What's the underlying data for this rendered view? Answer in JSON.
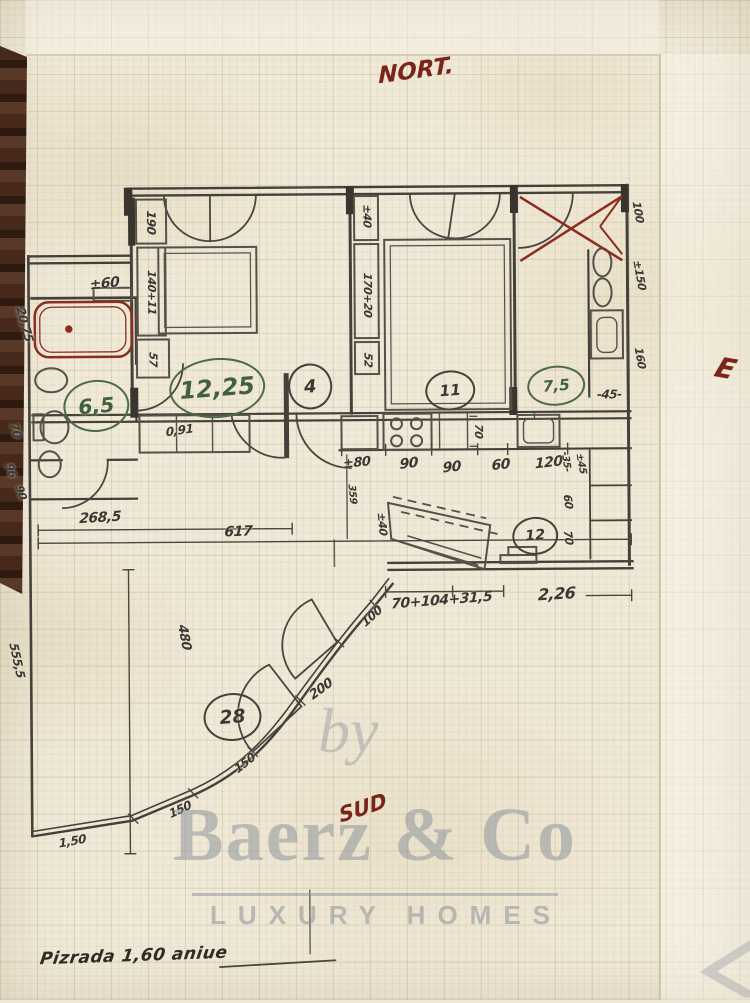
{
  "compass": {
    "north": "NORT.",
    "south": "SUD",
    "east": "E"
  },
  "note_bottom": "Pizrada 1,60 aniue",
  "watermark": {
    "by": "by",
    "brand": "Baerz & Co",
    "tagline": "LUXURY HOMES"
  },
  "colors": {
    "ink": "#3b3732",
    "red_ink": "#8c2d20",
    "maroon": "#7b241a",
    "green_ink": "#41603e",
    "paper": "#f0e9d7",
    "wood": "#46291b",
    "watermark_gray": "#8b929b"
  },
  "room_areas": [
    {
      "value": "6,5",
      "x": 97,
      "y": 404,
      "rx": 31,
      "ry": 24,
      "c": "green"
    },
    {
      "value": "12,25",
      "x": 218,
      "y": 387,
      "rx": 46,
      "ry": 28,
      "c": "green"
    },
    {
      "value": "4",
      "x": 311,
      "y": 386,
      "rx": 20,
      "ry": 21,
      "c": "ink"
    },
    {
      "value": "11",
      "x": 451,
      "y": 391,
      "rx": 23,
      "ry": 18,
      "c": "ink"
    },
    {
      "value": "7,5",
      "x": 557,
      "y": 387,
      "rx": 27,
      "ry": 18,
      "c": "green"
    },
    {
      "value": "12",
      "x": 535,
      "y": 537,
      "rx": 21,
      "ry": 17,
      "c": "ink"
    },
    {
      "value": "28",
      "x": 231,
      "y": 716,
      "rx": 27,
      "ry": 22,
      "c": "ink"
    }
  ],
  "dimensions": [
    {
      "t": "±60",
      "x": 106,
      "y": 282,
      "r": -6,
      "s": 14
    },
    {
      "t": "190",
      "x": 153,
      "y": 221,
      "r": 90,
      "s": 12
    },
    {
      "t": "140+11",
      "x": 153,
      "y": 291,
      "r": 90,
      "s": 11
    },
    {
      "t": "57",
      "x": 154,
      "y": 358,
      "r": 90,
      "s": 11
    },
    {
      "t": "20,75",
      "x": 26,
      "y": 322,
      "r": 75,
      "s": 12
    },
    {
      "t": "70",
      "x": 16,
      "y": 428,
      "r": 72,
      "s": 12
    },
    {
      "t": "96",
      "x": 11,
      "y": 468,
      "r": 72,
      "s": 11
    },
    {
      "t": "90",
      "x": 21,
      "y": 490,
      "r": 72,
      "s": 11
    },
    {
      "t": "555,5",
      "x": 16,
      "y": 658,
      "r": 78,
      "s": 12
    },
    {
      "t": "0,91",
      "x": 180,
      "y": 429,
      "r": -8,
      "s": 12
    },
    {
      "t": "±80",
      "x": 357,
      "y": 463,
      "r": -6,
      "s": 13
    },
    {
      "t": "90",
      "x": 409,
      "y": 464,
      "r": -6,
      "s": 14
    },
    {
      "t": "90",
      "x": 452,
      "y": 468,
      "r": -6,
      "s": 14
    },
    {
      "t": "60",
      "x": 501,
      "y": 466,
      "r": -6,
      "s": 14
    },
    {
      "t": "120",
      "x": 549,
      "y": 464,
      "r": -6,
      "s": 14
    },
    {
      "t": "±45",
      "x": 581,
      "y": 465,
      "r": 80,
      "s": 10
    },
    {
      "t": "70",
      "x": 479,
      "y": 432,
      "r": 90,
      "s": 11
    },
    {
      "t": "-45-",
      "x": 610,
      "y": 396,
      "r": 0,
      "s": 12
    },
    {
      "t": "±40",
      "x": 369,
      "y": 216,
      "r": 90,
      "s": 11
    },
    {
      "t": "170+20",
      "x": 369,
      "y": 295,
      "r": 90,
      "s": 11
    },
    {
      "t": "52",
      "x": 369,
      "y": 360,
      "r": 90,
      "s": 11
    },
    {
      "t": "100",
      "x": 640,
      "y": 214,
      "r": 80,
      "s": 11
    },
    {
      "t": "±150",
      "x": 641,
      "y": 277,
      "r": 80,
      "s": 11
    },
    {
      "t": "160",
      "x": 641,
      "y": 360,
      "r": 80,
      "s": 11
    },
    {
      "t": "-35-",
      "x": 566,
      "y": 463,
      "r": 82,
      "s": 10
    },
    {
      "t": "60",
      "x": 568,
      "y": 503,
      "r": 82,
      "s": 11
    },
    {
      "t": "70",
      "x": 568,
      "y": 539,
      "r": 82,
      "s": 11
    },
    {
      "t": "2,26",
      "x": 556,
      "y": 595,
      "r": -3,
      "s": 16
    },
    {
      "t": "70+104+31,5",
      "x": 441,
      "y": 601,
      "r": -4,
      "s": 14
    },
    {
      "t": "±40",
      "x": 382,
      "y": 524,
      "r": 85,
      "s": 11
    },
    {
      "t": "100",
      "x": 371,
      "y": 616,
      "r": -42,
      "s": 12
    },
    {
      "t": "200",
      "x": 320,
      "y": 689,
      "r": -36,
      "s": 13
    },
    {
      "t": "150",
      "x": 243,
      "y": 762,
      "r": -38,
      "s": 12
    },
    {
      "t": "150",
      "x": 178,
      "y": 808,
      "r": -25,
      "s": 12
    },
    {
      "t": "1,50",
      "x": 70,
      "y": 839,
      "r": -10,
      "s": 12
    },
    {
      "t": "480",
      "x": 183,
      "y": 636,
      "r": 80,
      "s": 13
    },
    {
      "t": "359",
      "x": 352,
      "y": 494,
      "r": 85,
      "s": 10
    },
    {
      "t": "268,5",
      "x": 100,
      "y": 516,
      "r": -3,
      "s": 14
    },
    {
      "t": "617",
      "x": 238,
      "y": 531,
      "r": -2,
      "s": 14
    }
  ]
}
